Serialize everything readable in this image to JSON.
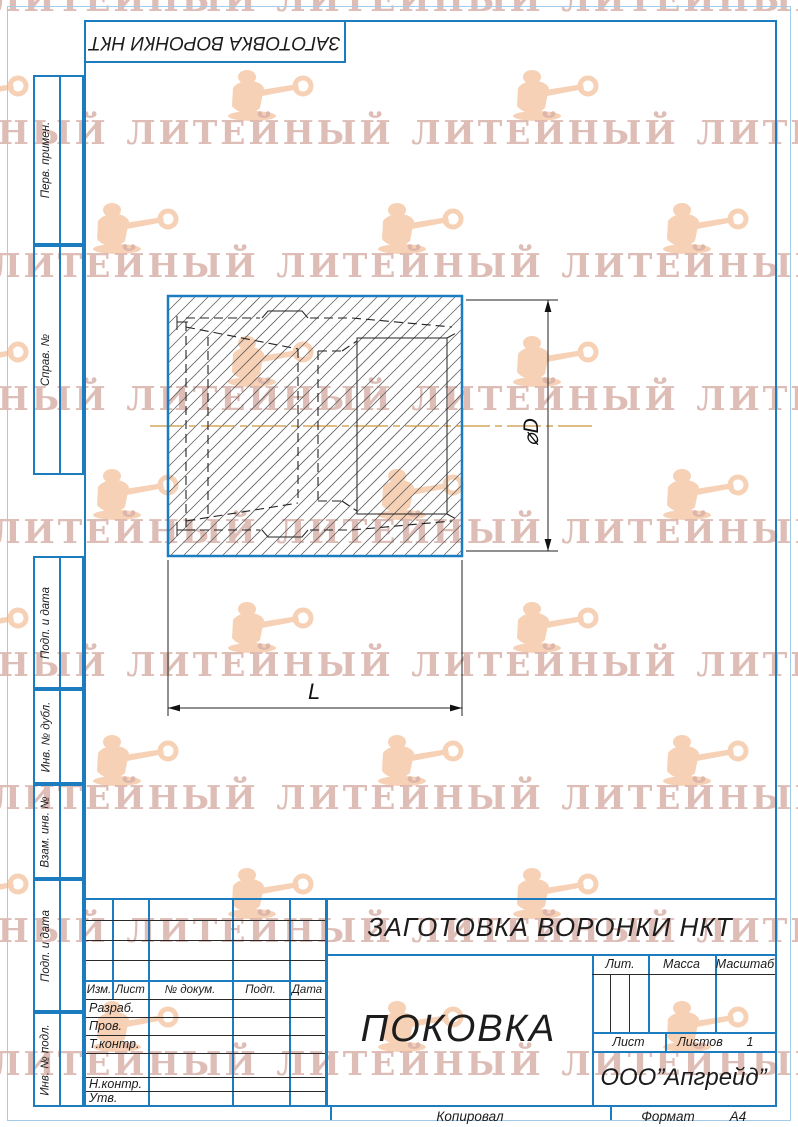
{
  "designation_box": {
    "text": "ЗАГОТОВКА ВОРОНКИ НКТ"
  },
  "side_labels": [
    "Перв. примен.",
    "Справ. №",
    "Подп. и дата",
    "Инв. № дубл.",
    "Взам. инв. №",
    "Подп. и дата",
    "Инв. № подл."
  ],
  "drawing": {
    "diameter_label": "⌀D",
    "length_label": "L"
  },
  "title_block": {
    "rev_headers": [
      "Изм.",
      "Лист",
      "№ докум.",
      "Подп.",
      "Дата"
    ],
    "sign_rows": [
      "Разраб.",
      "Пров.",
      "Т.контр.",
      "",
      "Н.контр.",
      "Утв."
    ],
    "doc_title": "ЗАГОТОВКА ВОРОНКИ НКТ",
    "part_name": "ПОКОВКА",
    "lit_label": "Лит.",
    "mass_label": "Масса",
    "scale_label": "Масштаб",
    "sheet_label": "Лист",
    "sheets_label": "Листов",
    "sheets_value": "1",
    "company": "ООО”Апгрейд”"
  },
  "footer": {
    "copied": "Копировал",
    "format_label": "Формат",
    "format_value": "А4"
  },
  "watermark": {
    "text": "ЛИТЕЙНЫЙ"
  },
  "colors": {
    "frame_blue": "#1c7cc0",
    "centerline_orange": "#c9973f",
    "watermark_text": "#d9b2aa",
    "watermark_figure": "#f5c6a3",
    "hatch_gray": "#5f5f5f"
  }
}
